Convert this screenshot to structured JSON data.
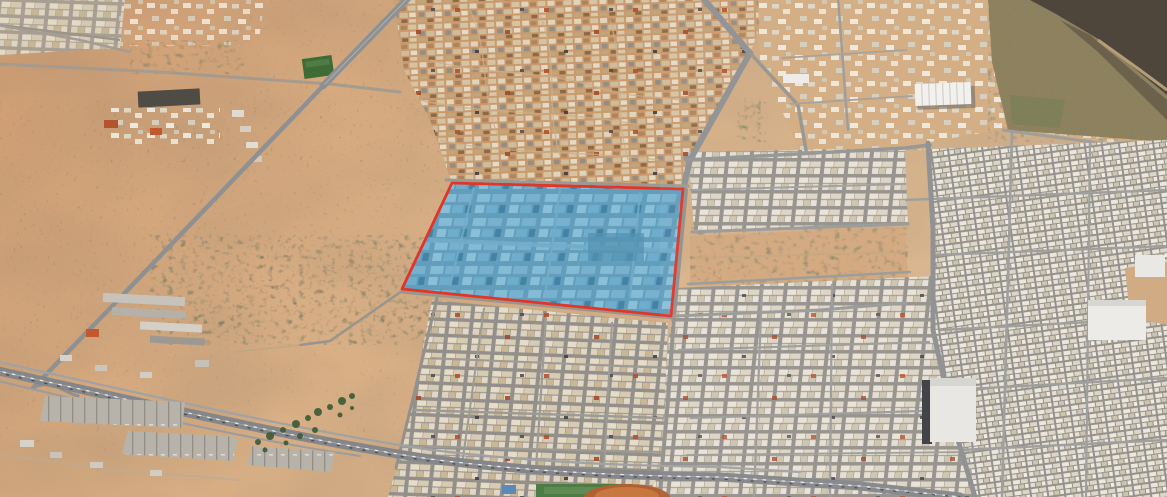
{
  "view": {
    "type": "aerial-satellite-3d-view",
    "description": "Oblique aerial satellite imagery of a desert city. A large rectangular industrial district in the center is selected: outlined in red and shaded translucent blue. Desert and a highway lie to the southwest, an old town to the north, dense residential grids to the east and south, and a dark rocky ridge at the far northeast.",
    "width_px": 1167,
    "height_px": 497
  },
  "overlay": {
    "parcel": {
      "label": "selected-district",
      "points": "452,183 683,189 671,316 402,289",
      "stroke_color": "#e23427",
      "stroke_width": 2.8,
      "fill_color": "#2f8fc0",
      "fill_opacity": 0.3
    }
  },
  "palette": {
    "desert_sand": "#cf9c72",
    "desert_mid": "#d9af85",
    "desert_light": "#d9b68e",
    "city_street_gray": "#94918c",
    "building_white": "#e9e3d6",
    "old_town_sand": "#c89a6e",
    "highlight_blue_ground": "#79a5bb",
    "highway_gray": "#84868a",
    "vegetation_green": "#3e5c36",
    "farm_green": "#3f6b35",
    "ridge_dark": "#473f33",
    "ridge_slope": "#8a7c58"
  }
}
